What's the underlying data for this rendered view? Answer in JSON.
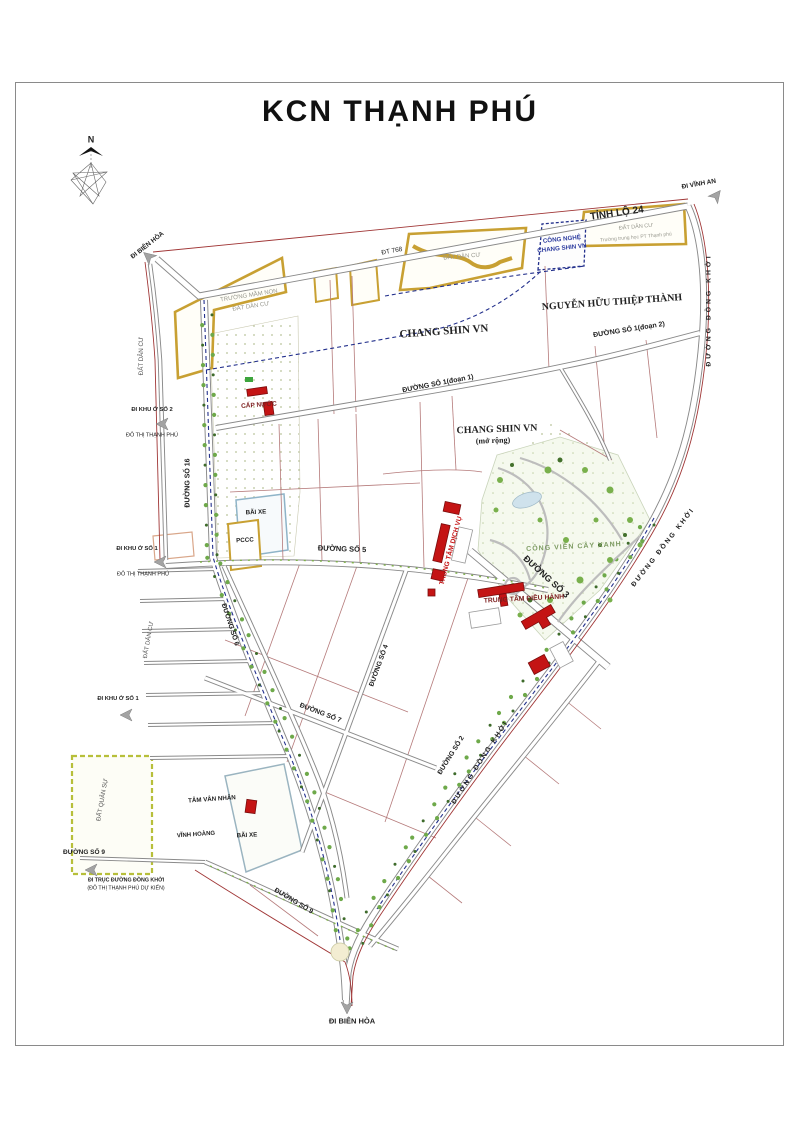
{
  "page": {
    "title": "KCN THẠNH PHÚ"
  },
  "compass": {
    "north_label": "N"
  },
  "colors": {
    "parcel_gold": "#c8a032",
    "planning_navy": "#23308c",
    "building_red": "#c41414",
    "boundary_red": "#a03636",
    "parcel_line_maroon": "#b57a7a",
    "text_gray": "#98988e",
    "text_blue": "#2b3a9e",
    "text_dark_red": "#7d1f1f",
    "park_green": "#7d9b62",
    "road_casing": "#8a8a8a"
  },
  "map": {
    "labels": [
      {
        "id": "compass-n",
        "text": "N",
        "x": 91,
        "y": 140,
        "rot": 0,
        "fs": 9,
        "bold": 1
      },
      {
        "id": "di-bien-hoa-top",
        "text": "ĐI BIÊN HÒA",
        "x": 148,
        "y": 246,
        "rot": -38,
        "fs": 6.5,
        "bold": 1
      },
      {
        "id": "dt-768",
        "text": "ĐT 768",
        "x": 392,
        "y": 252,
        "rot": -10,
        "fs": 6.5
      },
      {
        "id": "tinh-lo-24",
        "text": "TỈNH LỘ 24",
        "x": 617,
        "y": 214,
        "rot": -8,
        "fs": 10,
        "bold": 1
      },
      {
        "id": "di-vinh-an",
        "text": "ĐI VĨNH AN",
        "x": 699,
        "y": 185,
        "rot": -10,
        "fs": 6.5,
        "bold": 1
      },
      {
        "id": "truong-mam-non",
        "text": "TRƯỜNG MẦM NON",
        "x": 249,
        "y": 296,
        "rot": -9,
        "fs": 6,
        "color": "#98988e"
      },
      {
        "id": "dat-dan-cu-a",
        "text": "ĐẤT DÂN CƯ",
        "x": 251,
        "y": 307,
        "rot": -9,
        "fs": 6,
        "color": "#98988e"
      },
      {
        "id": "dat-dan-cu-b",
        "text": "ĐẤT DÂN CƯ",
        "x": 462,
        "y": 257,
        "rot": -5,
        "fs": 6,
        "color": "#98988e"
      },
      {
        "id": "cong-nghe-1",
        "text": "CÔNG NGHỆ",
        "x": 562,
        "y": 240,
        "rot": -6,
        "fs": 6.2,
        "color": "#2b3a9e",
        "bold": 1
      },
      {
        "id": "cong-nghe-2",
        "text": "CHANG SHIN VN",
        "x": 562,
        "y": 249,
        "rot": -6,
        "fs": 6.2,
        "color": "#2b3a9e",
        "bold": 1
      },
      {
        "id": "dat-dan-cu-c",
        "text": "ĐẤT DÂN CƯ",
        "x": 636,
        "y": 228,
        "rot": -5,
        "fs": 5.5,
        "color": "#98988e"
      },
      {
        "id": "truong-trung-hoc",
        "text": "Trường trung học PT Thạnh phú",
        "x": 636,
        "y": 238,
        "rot": -5,
        "fs": 5,
        "color": "#98988e"
      },
      {
        "id": "chang-shin-vn",
        "text": "CHANG SHIN VN",
        "x": 444,
        "y": 332,
        "rot": -4,
        "fs": 11,
        "bold": 1,
        "serif": 1
      },
      {
        "id": "nguyen-huu-thiep-thanh",
        "text": "NGUYỄN HỮU THIỆP THÀNH",
        "x": 612,
        "y": 303,
        "rot": -4,
        "fs": 10,
        "bold": 1,
        "serif": 1
      },
      {
        "id": "duong-so-1-doan-2",
        "text": "ĐƯỜNG SỐ 1(đoạn 2)",
        "x": 629,
        "y": 330,
        "rot": -9,
        "fs": 7,
        "bold": 1
      },
      {
        "id": "duong-so-1-doan-1",
        "text": "ĐƯỜNG SỐ 1(đoạn 1)",
        "x": 438,
        "y": 384,
        "rot": -11,
        "fs": 7,
        "bold": 1
      },
      {
        "id": "chang-shin-mo-rong-1",
        "text": "CHANG SHIN VN",
        "x": 497,
        "y": 430,
        "rot": -2,
        "fs": 10,
        "bold": 1,
        "serif": 1
      },
      {
        "id": "chang-shin-mo-rong-2",
        "text": "(mở rộng)",
        "x": 493,
        "y": 441,
        "rot": -2,
        "fs": 8,
        "bold": 1,
        "serif": 1
      },
      {
        "id": "cap-nuoc",
        "text": "CẤP NƯỚC",
        "x": 259,
        "y": 406,
        "rot": -4,
        "fs": 6.5,
        "color": "#7d1f1f",
        "bold": 1
      },
      {
        "id": "dat-dan-cu-left-1",
        "text": "ĐẤT DÂN CƯ",
        "x": 142,
        "y": 356,
        "rot": -90,
        "fs": 6.2,
        "color": "#555555"
      },
      {
        "id": "di-khu-o-so-2",
        "text": "ĐI KHU Ở SỐ 2",
        "x": 152,
        "y": 411,
        "rot": 0,
        "fs": 5.8,
        "bold": 1
      },
      {
        "id": "do-thi-thanh-phu-1",
        "text": "ĐÔ THỊ THẠNH PHÚ",
        "x": 152,
        "y": 436,
        "rot": 0,
        "fs": 5.5
      },
      {
        "id": "duong-so-16",
        "text": "ĐƯỜNG SỐ 16",
        "x": 188,
        "y": 483,
        "rot": -90,
        "fs": 7,
        "bold": 1
      },
      {
        "id": "bai-xe-1",
        "text": "BÃI XE",
        "x": 256,
        "y": 513,
        "rot": -3,
        "fs": 6.2,
        "bold": 1
      },
      {
        "id": "pccc",
        "text": "PCCC",
        "x": 245,
        "y": 541,
        "rot": -3,
        "fs": 6.2,
        "bold": 1
      },
      {
        "id": "duong-so-5",
        "text": "ĐƯỜNG SỐ 5",
        "x": 342,
        "y": 549,
        "rot": 2,
        "fs": 7.5,
        "bold": 1
      },
      {
        "id": "di-khu-o-so-1a",
        "text": "ĐI KHU Ở SỐ 1",
        "x": 137,
        "y": 550,
        "rot": 0,
        "fs": 5.8,
        "bold": 1
      },
      {
        "id": "do-thi-thanh-phu-2",
        "text": "ĐÔ THỊ THẠNH PHÚ",
        "x": 143,
        "y": 575,
        "rot": 0,
        "fs": 5.5
      },
      {
        "id": "trung-tam-dich-vu",
        "text": "TRUNG TÂM DỊCH VỤ",
        "x": 452,
        "y": 551,
        "rot": -75,
        "fs": 6.8,
        "color": "#c41414",
        "bold": 1
      },
      {
        "id": "cong-vien-cay-xanh",
        "text": "CÔNG VIÊN CÂY XANH",
        "x": 574,
        "y": 547,
        "rot": -3,
        "fs": 7,
        "color": "#7d9b62",
        "bold": 1,
        "ls": 1
      },
      {
        "id": "duong-so-3",
        "text": "ĐƯỜNG SỐ 3",
        "x": 546,
        "y": 577,
        "rot": 42,
        "fs": 9,
        "bold": 1
      },
      {
        "id": "trung-tam-dieu-hanh",
        "text": "TRUNG TÂM ĐIỀU HÀNH",
        "x": 524,
        "y": 600,
        "rot": -3,
        "fs": 6.8,
        "color": "#7d1f1f",
        "bold": 1
      },
      {
        "id": "dat-dan-cu-left-2",
        "text": "ĐẤT DÂN CƯ",
        "x": 149,
        "y": 640,
        "rot": -80,
        "fs": 6,
        "color": "#555555"
      },
      {
        "id": "duong-so-6",
        "text": "ĐƯỜNG SỐ 6",
        "x": 229,
        "y": 625,
        "rot": 72,
        "fs": 6.8,
        "bold": 1
      },
      {
        "id": "duong-so-4",
        "text": "ĐƯỜNG SỐ 4",
        "x": 380,
        "y": 666,
        "rot": -70,
        "fs": 6.8,
        "bold": 1
      },
      {
        "id": "di-khu-o-so-1b",
        "text": "ĐI KHU Ở SỐ 1",
        "x": 118,
        "y": 700,
        "rot": 0,
        "fs": 5.8,
        "bold": 1
      },
      {
        "id": "duong-so-7",
        "text": "ĐƯỜNG SỐ 7",
        "x": 320,
        "y": 714,
        "rot": 21,
        "fs": 6.8,
        "bold": 1
      },
      {
        "id": "duong-so-2",
        "text": "ĐƯỜNG SỐ 2",
        "x": 452,
        "y": 756,
        "rot": -58,
        "fs": 6.8,
        "bold": 1
      },
      {
        "id": "duong-dong-khoi-1",
        "text": "ĐƯỜNG ĐỒNG KHỞI",
        "x": 710,
        "y": 310,
        "rot": -90,
        "fs": 6.8,
        "bold": 1,
        "ls": 3
      },
      {
        "id": "duong-dong-khoi-2",
        "text": "ĐƯỜNG ĐỒNG KHỞI",
        "x": 664,
        "y": 548,
        "rot": -52,
        "fs": 6.8,
        "bold": 1,
        "ls": 2
      },
      {
        "id": "duong-dong-khoi-3",
        "text": "ĐƯỜNG ĐỒNG KHỞI",
        "x": 481,
        "y": 763,
        "rot": -57,
        "fs": 6.8,
        "bold": 1,
        "ls": 2
      },
      {
        "id": "dat-quan-su",
        "text": "ĐẤT QUÂN SỰ",
        "x": 103,
        "y": 800,
        "rot": -80,
        "fs": 6.2,
        "color": "#555555"
      },
      {
        "id": "duong-so-9a",
        "text": "ĐƯỜNG SỐ 9",
        "x": 84,
        "y": 853,
        "rot": 0,
        "fs": 6.5,
        "bold": 1
      },
      {
        "id": "di-truc-dong-khoi-1",
        "text": "ĐI TRỤC ĐƯỜNG ĐỒNG KHỞI",
        "x": 126,
        "y": 881,
        "rot": 0,
        "fs": 5.3,
        "bold": 1
      },
      {
        "id": "di-truc-dong-khoi-2",
        "text": "(ĐÔ THỊ THẠNH PHÚ DỰ KIẾN)",
        "x": 126,
        "y": 889,
        "rot": 0,
        "fs": 5.3
      },
      {
        "id": "tam-van-nhan",
        "text": "TÂM VÂN NHÂN",
        "x": 212,
        "y": 800,
        "rot": -4,
        "fs": 6.2,
        "bold": 1
      },
      {
        "id": "vinh-hoang",
        "text": "VĨNH HOÀNG",
        "x": 196,
        "y": 835,
        "rot": -4,
        "fs": 6,
        "bold": 1
      },
      {
        "id": "bai-xe-2",
        "text": "BÃI XE",
        "x": 247,
        "y": 836,
        "rot": -3,
        "fs": 6.2,
        "bold": 1
      },
      {
        "id": "duong-so-9b",
        "text": "ĐƯỜNG SỐ 9",
        "x": 293,
        "y": 902,
        "rot": 31,
        "fs": 6.8,
        "bold": 1
      },
      {
        "id": "di-bien-hoa-bottom",
        "text": "ĐI BIÊN HÒA",
        "x": 352,
        "y": 1021,
        "rot": 0,
        "fs": 7.5,
        "bold": 1
      }
    ]
  }
}
